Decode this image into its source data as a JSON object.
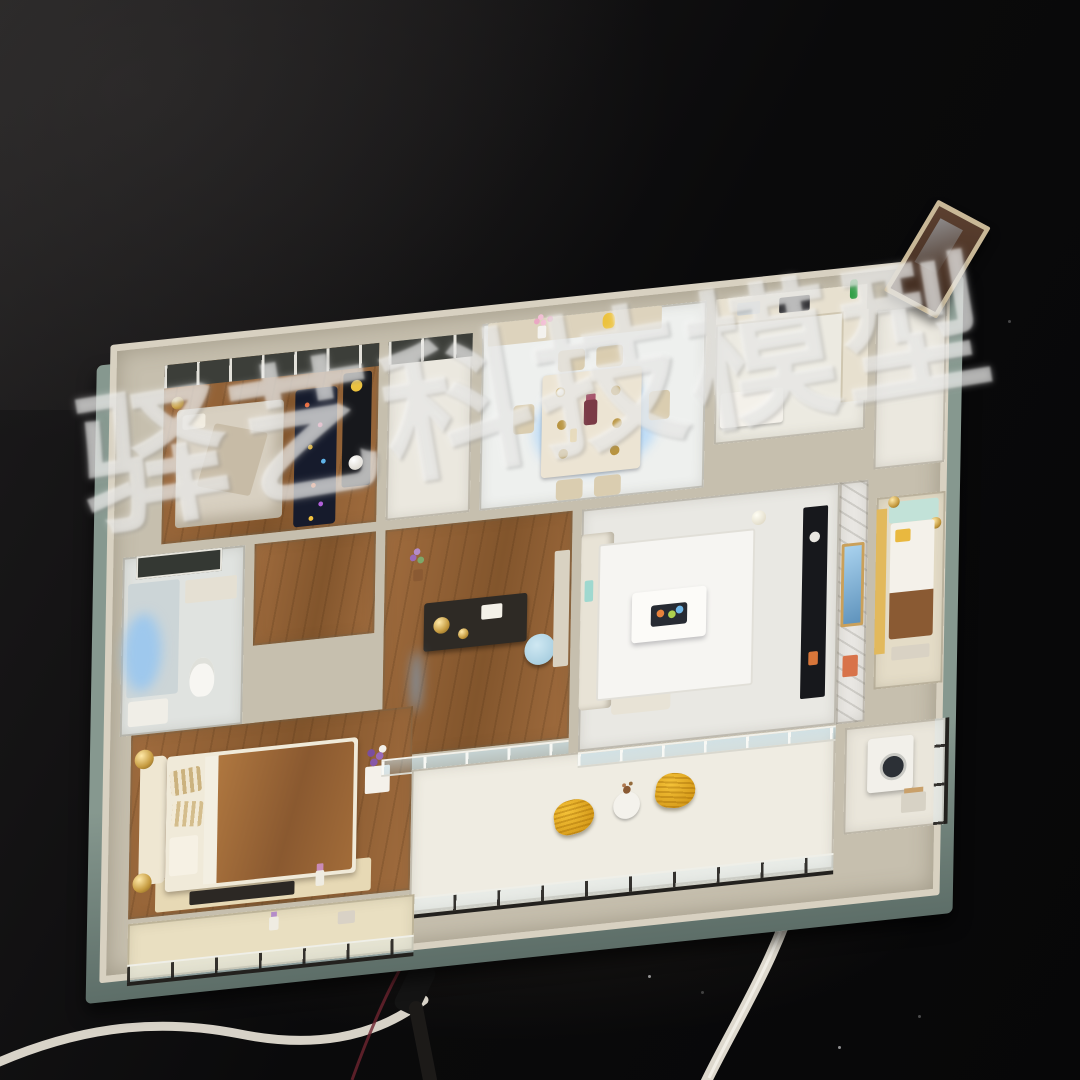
{
  "photo": {
    "description": "Photograph of a miniature apartment scale model (dollhouse-style sales model) viewed from above on a black backdrop, with interior LED lighting, furnished rooms and power cables on the table",
    "watermark": {
      "text": "驿艺科技模型"
    }
  },
  "palette": {
    "backdrop": "#0a0a0b",
    "base": "#86988f",
    "baseDark": "#5d6e68",
    "wall": "#c6bfae",
    "wallLight": "#d8d1c1",
    "wood": "#a06c3e",
    "woodDark": "#82552c",
    "floorLight": "#ebe8df",
    "floorWhite": "#f6f5f2",
    "dark": "#3c3e39",
    "black": "#17181c",
    "marble": "#e9e7e3",
    "glassBlue": "#bcd7e2",
    "led": "#8ec6f2",
    "yellow": "#e9b83f",
    "gold": "#c59a3f",
    "bedBrown": "#a76f39",
    "cream": "#efe7d2",
    "teal": "#c2e2d8",
    "navyRug": "#161b2c",
    "cable": "#e9e4d8",
    "watermark": "rgba(248,248,246,0.52)"
  }
}
